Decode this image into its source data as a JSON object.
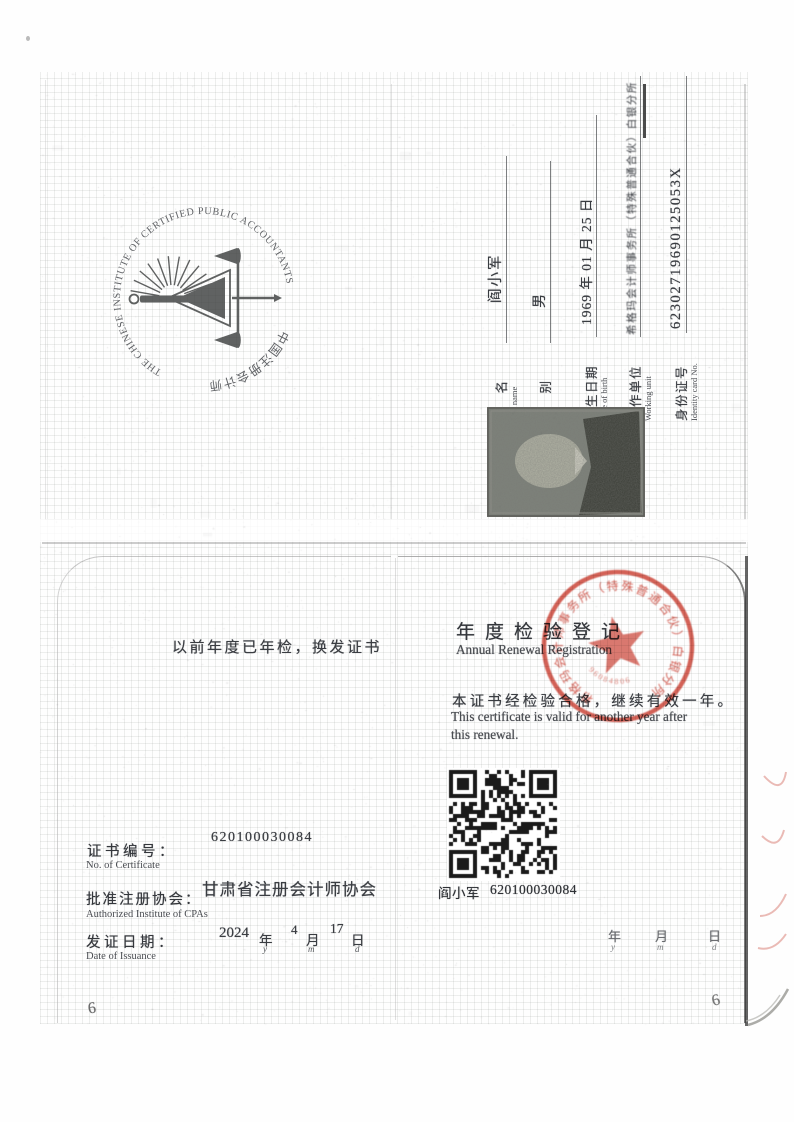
{
  "logo": {
    "ring_en": "THE CHINESE INSTITUTE OF CERTIFIED PUBLIC ACCOUNTANTS",
    "ring_zh": "中国注册会计师协会"
  },
  "holder": {
    "fields": [
      {
        "zh": "姓名",
        "en": "Full name",
        "value": "阎小军"
      },
      {
        "zh": "性别",
        "en": "Sex",
        "value": "男"
      },
      {
        "zh": "出生日期",
        "en": "Date of birth",
        "value": "1969 年 01 月 25 日"
      },
      {
        "zh": "工作单位",
        "en": "Working unit",
        "value": "希格玛会计师事务所（特殊普通合伙）白银分所"
      },
      {
        "zh": "身份证号",
        "en": "Identity card No.",
        "value": "62302719690125053X"
      }
    ]
  },
  "left_page": {
    "note": "以前年度已年检，换发证书",
    "cert_no": {
      "zh": "证书编号：",
      "en": "No. of Certificate",
      "value": "620100030084"
    },
    "institute": {
      "zh": "批准注册协会：",
      "en": "Authorized Institute of CPAs",
      "value": "甘肃省注册会计师协会"
    },
    "issue": {
      "zh": "发证日期：",
      "en": "Date of Issuance",
      "year": "2024",
      "year_u": "年",
      "y": "y",
      "month": "4",
      "month_u": "月",
      "m": "m",
      "day": "17",
      "day_u": "日",
      "d": "d"
    }
  },
  "right_page": {
    "title_zh": "年度检验登记",
    "title_en": "Annual Renewal Registration",
    "body_zh": "本证书经检验合格，继续有效一年。",
    "body_en1": "This certificate is valid for another year after",
    "body_en2": "this renewal.",
    "qr_caption_name": "阎小军",
    "qr_caption_no": "620100030084",
    "blank_date": {
      "year_u": "年",
      "y": "y",
      "month_u": "月",
      "m": "m",
      "day_u": "日",
      "d": "d"
    }
  },
  "stamp": {
    "ring_text": "希格玛会计师事务所（特殊普通合伙）白银分所",
    "serial": "96084806",
    "color": "#cc4437"
  },
  "marks": {
    "page_left": "6",
    "page_right": "6"
  }
}
